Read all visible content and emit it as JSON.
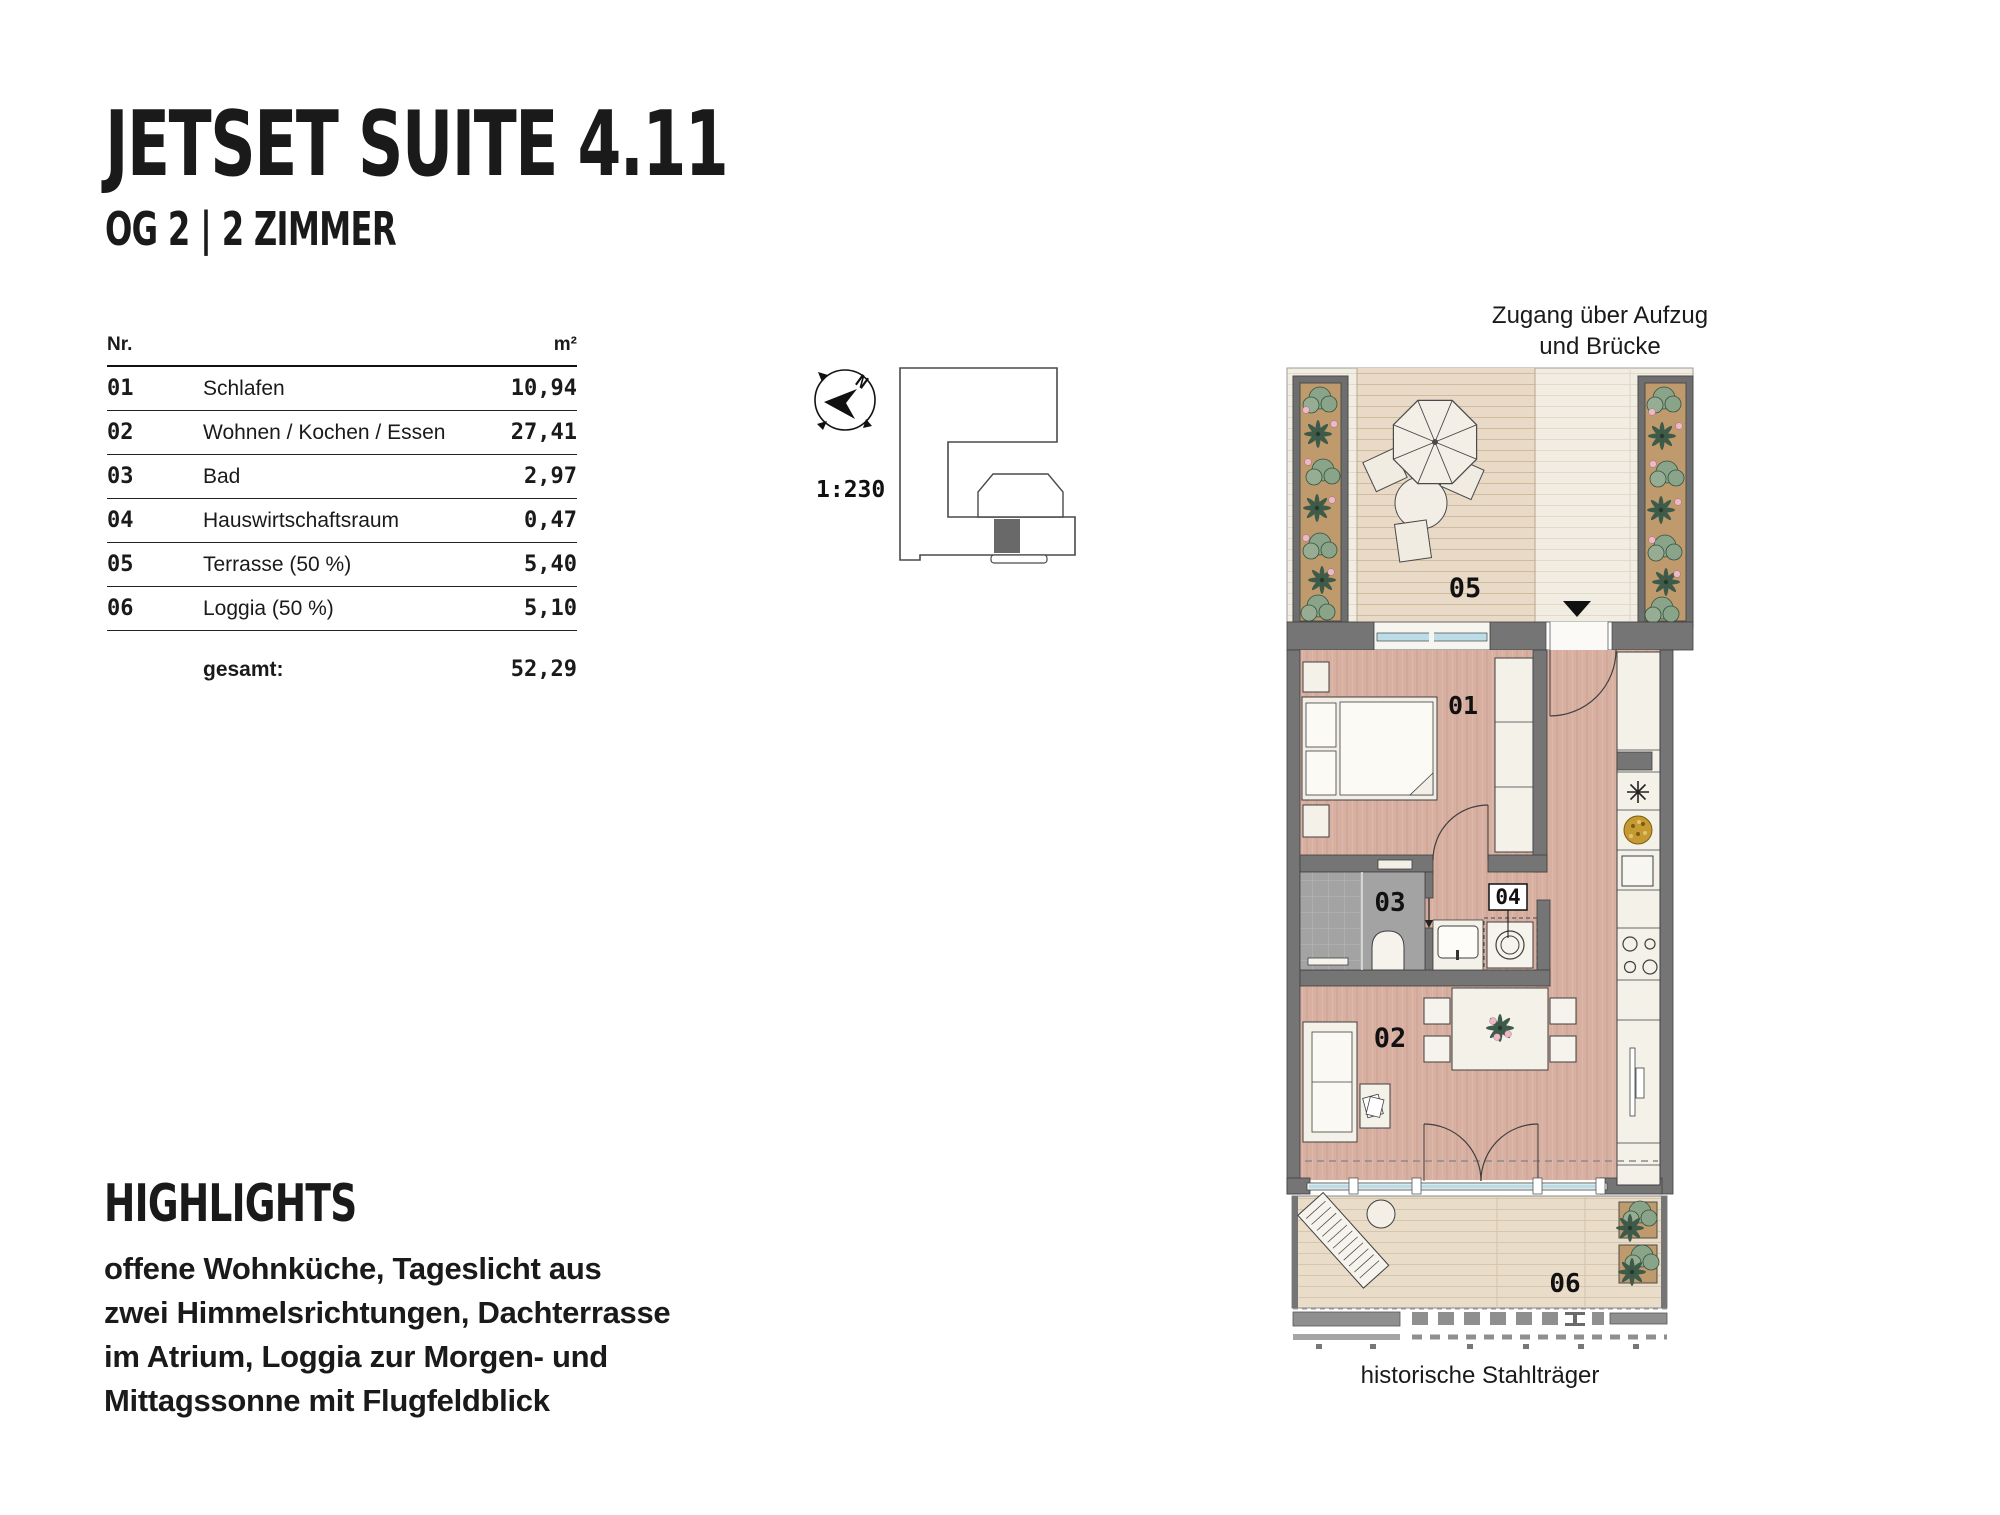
{
  "page": {
    "title": "JETSET SUITE 4.11",
    "subtitle": "OG 2 | 2 ZIMMER"
  },
  "area_table": {
    "col_nr": "Nr.",
    "col_sqm": "m²",
    "rows": [
      {
        "nr": "01",
        "name": "Schlafen",
        "sqm": "10,94"
      },
      {
        "nr": "02",
        "name": "Wohnen / Kochen / Essen",
        "sqm": "27,41"
      },
      {
        "nr": "03",
        "name": "Bad",
        "sqm": "2,97"
      },
      {
        "nr": "04",
        "name": "Hauswirtschaftsraum",
        "sqm": "0,47"
      },
      {
        "nr": "05",
        "name": "Terrasse (50 %)",
        "sqm": "5,40"
      },
      {
        "nr": "06",
        "name": "Loggia (50 %)",
        "sqm": "5,10"
      }
    ],
    "total_label": "gesamt:",
    "total_value": "52,29"
  },
  "site_key": {
    "north_label": "N",
    "scale": "1:230"
  },
  "floor_plan": {
    "access_note_line1": "Zugang über Aufzug",
    "access_note_line2": "und Brücke",
    "labels": {
      "bedroom": "01",
      "living": "02",
      "bath": "03",
      "utility": "04",
      "terrace": "05",
      "loggia": "06"
    },
    "caption": "historische Stahlträger"
  },
  "highlights": {
    "heading": "HIGHLIGHTS",
    "lines": [
      "offene Wohnküche, Tageslicht aus",
      "zwei Himmelsrichtungen, Dachterrasse",
      "im Atrium, Loggia zur Morgen- und",
      "Mittagssonne mit Flugfeldblick"
    ]
  },
  "colors": {
    "wall": "#757575",
    "wood": "#d8b0a1",
    "terrace_deck": "#e8dac6",
    "terrace_light": "#f2ede3",
    "loggia_deck": "#e9dcc9",
    "bath_tile": "#a3a3a3",
    "glazing": "#bcdde7",
    "soil": "#bf9a6c",
    "plant": "#8aa489",
    "plant_dark": "#3e5a49",
    "flower": "#ecb9c6",
    "bowl": "#c59a33",
    "ink": "#1a1a1a"
  }
}
